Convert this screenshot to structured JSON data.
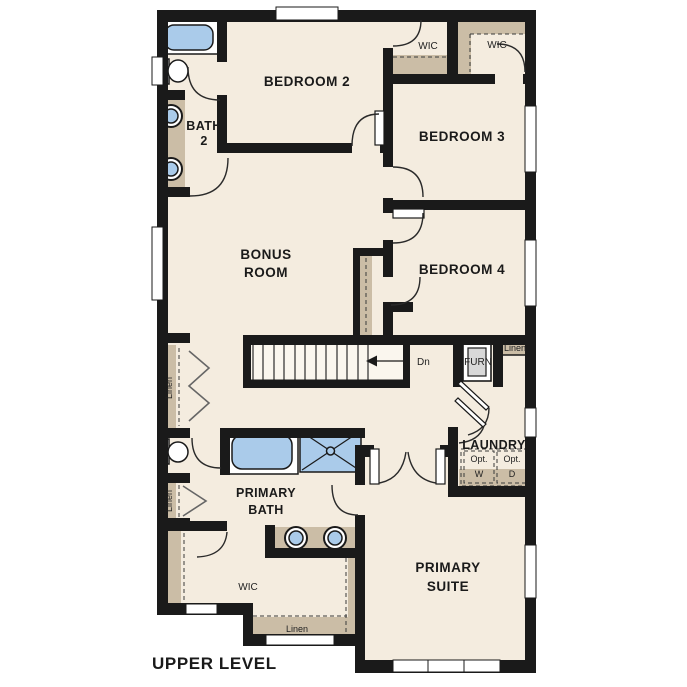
{
  "title": "UPPER LEVEL",
  "colors": {
    "floor": "#f4ecdf",
    "tan": "#cbbda6",
    "wall": "#1a1a1a",
    "blue": "#aacbea",
    "machine": "#e2e6e3",
    "furnace": "#d8d8d8"
  },
  "rooms": {
    "bedroom2": "BEDROOM 2",
    "bedroom3": "BEDROOM 3",
    "bedroom4": "BEDROOM 4",
    "bonus_line1": "BONUS",
    "bonus_line2": "ROOM",
    "bath2_line1": "BATH",
    "bath2_line2": "2",
    "primary_bath_line1": "PRIMARY",
    "primary_bath_line2": "BATH",
    "primary_suite_line1": "PRIMARY",
    "primary_suite_line2": "SUITE",
    "laundry": "LAUNDRY"
  },
  "closets": {
    "wic_bedroom2": "WIC",
    "wic_bedroom3": "WIC",
    "wic_primary": "WIC",
    "linen_hall": "Linen",
    "linen_bath": "Linen",
    "linen_laundry": "Linen",
    "linen_nook": "Linen",
    "furnace": "FURN"
  },
  "stairs": {
    "direction_label": "Dn"
  },
  "appliances": {
    "washer_line1": "Opt.",
    "washer_line2": "W",
    "dryer_line1": "Opt.",
    "dryer_line2": "D"
  }
}
